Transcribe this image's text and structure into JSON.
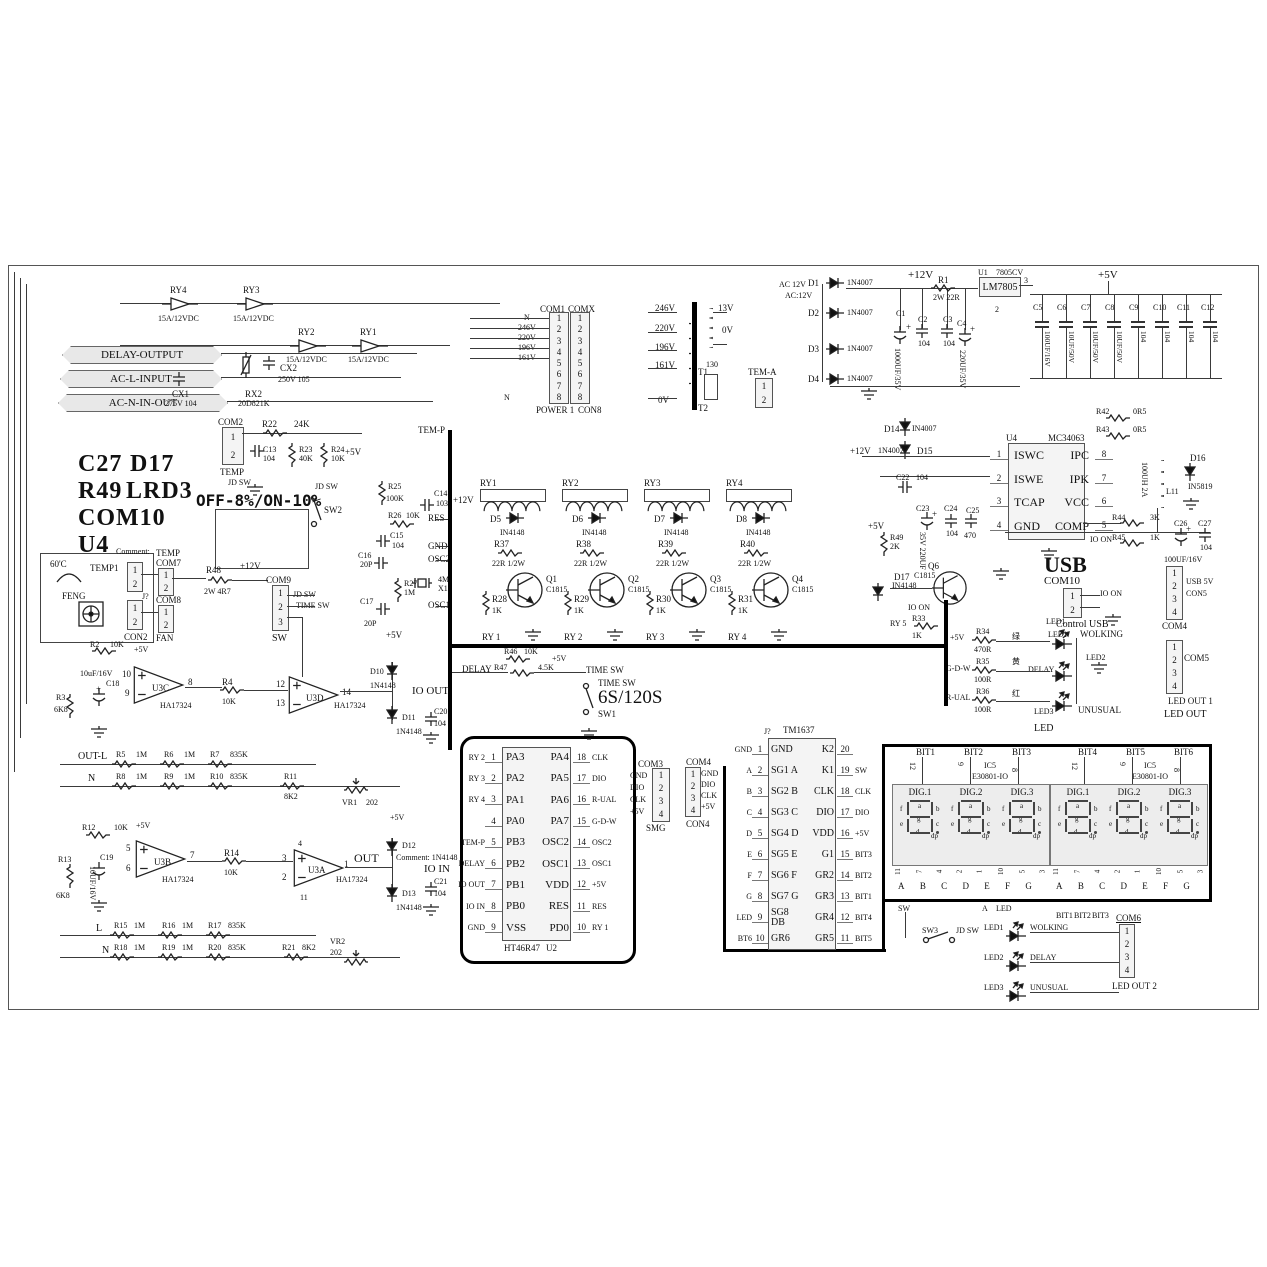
{
  "io_tags": {
    "delay_output": "DELAY-OUTPUT",
    "ac_l_input": "AC-L-INPUT",
    "ac_n_in_out": "AC-N-IN-OUT"
  },
  "top_relays": [
    {
      "ref": "RY4",
      "rating": "15A/12VDC"
    },
    {
      "ref": "RY3",
      "rating": "15A/12VDC"
    },
    {
      "ref": "RY2",
      "rating": "15A/12VDC"
    },
    {
      "ref": "RY1",
      "rating": "15A/12VDC"
    }
  ],
  "line_filter": {
    "cx1": "CX1",
    "cx1_val": "275V 104",
    "rx2": "RX2",
    "rx2_val": "20D821K",
    "cx2": "CX2",
    "cx2_val": "250V 105"
  },
  "com2": {
    "ref": "COM2",
    "pins": [
      "1",
      "2"
    ],
    "label": "TEMP",
    "jd": "JD SW"
  },
  "rc_top": {
    "r22": "R22",
    "r22_val": "24K",
    "c13": "C13",
    "c13_val": "104",
    "r23": "R23",
    "r23_val": "40K",
    "r24": "R24",
    "r24_val": "10K",
    "p5": "+5V",
    "jd": "JD SW",
    "jd2": "JD SW",
    "sw2": "SW2"
  },
  "tem_p": "TEM-P",
  "power_conn": {
    "com1": "COM1",
    "comx": "COMX",
    "nets": [
      "N",
      "246V",
      "220V",
      "196V",
      "161V"
    ],
    "pins": [
      "1",
      "2",
      "3",
      "4",
      "5",
      "6",
      "7",
      "8"
    ],
    "power": "POWER 1",
    "con8": "CON8",
    "n2": "N"
  },
  "transformer": {
    "taps": [
      "246V",
      "220V",
      "196V",
      "161V"
    ],
    "tap0": "0V",
    "sec_top": "13V",
    "sec_0": "0V",
    "t1": "T1",
    "t2": "T2",
    "fuse": "130",
    "tem_a": "TEM-A",
    "tem_pins": [
      "1",
      "2"
    ]
  },
  "rectifier": {
    "ac1": "AC 12V",
    "ac2": "AC:12V",
    "diodes": [
      {
        "ref": "D1",
        "val": "1N4007"
      },
      {
        "ref": "D2",
        "val": "1N4007"
      },
      {
        "ref": "D3",
        "val": "1N4007"
      },
      {
        "ref": "D4",
        "val": "1N4007"
      }
    ],
    "p12": "+12V",
    "r1": "R1",
    "r1_val": "2W 22R",
    "c1": "C1",
    "c1_val": "1000UF/35V",
    "c2": "C2",
    "c2_val": "104",
    "c3": "C3",
    "c3_val": "104",
    "c4": "C4",
    "c4_val": "220UF/35V",
    "u1": "U1",
    "u1_part": "7805CV",
    "reg": "LM7805",
    "pin2": "2",
    "pin3": "3"
  },
  "rail5": {
    "p5": "+5V",
    "caps": [
      {
        "ref": "C5",
        "val": "100UF/16V"
      },
      {
        "ref": "C6",
        "val": "10UF/50V"
      },
      {
        "ref": "C7",
        "val": "10UF/50V"
      },
      {
        "ref": "C8",
        "val": "10UF/50V"
      },
      {
        "ref": "C9",
        "val": "104"
      },
      {
        "ref": "C10",
        "val": "104"
      },
      {
        "ref": "C11",
        "val": "104"
      },
      {
        "ref": "C12",
        "val": "104"
      }
    ]
  },
  "dcdc": {
    "u4": "U4",
    "part": "MC34063",
    "rows": [
      {
        "ln": "1",
        "lname": "ISWC",
        "rname": "IPC",
        "rn": "8"
      },
      {
        "ln": "2",
        "lname": "ISWE",
        "rname": "IPK",
        "rn": "7"
      },
      {
        "ln": "3",
        "lname": "TCAP",
        "rname": "VCC",
        "rn": "6"
      },
      {
        "ln": "4",
        "lname": "GND",
        "rname": "COMP",
        "rn": "5"
      }
    ],
    "d14": "D14",
    "d14v": "IN4007",
    "d15": "D15",
    "d15v": "1N4007",
    "p12": "+12V",
    "c22": "C22",
    "c22v": "104",
    "r42": "R42",
    "r42v": "0R5",
    "r43": "R43",
    "r43v": "0R5",
    "p5": "+5V",
    "r49": "R49",
    "r49v": "2K",
    "c23": "C23",
    "c23v": "35V 220UF",
    "c24": "C24",
    "c24v": "104",
    "c25": "C25",
    "c25v": "470",
    "r44": "R44",
    "r44v": "3K",
    "io_on": "IO ON",
    "r45": "R45",
    "r45v": "1K",
    "l11": "L11",
    "l11v": "100UH 2A",
    "d16": "D16",
    "d16v": "IN5819",
    "c26": "C26",
    "c26v": "100UF/16V",
    "c27": "C27",
    "c27v": "104"
  },
  "usb": {
    "title": "USB",
    "com10": "COM10",
    "pins": [
      "1",
      "2"
    ],
    "io_on": "IO ON",
    "control": "Control USB",
    "led1": "LED1"
  },
  "q6blk": {
    "d17": "D17",
    "d17v": "IN4148",
    "q": "Q6",
    "qv": "C1815",
    "io_on": "IO ON",
    "ry5": "RY 5",
    "r33": "R33",
    "r33v": "1K"
  },
  "led_block": {
    "p5": "+5V",
    "r34": "R34",
    "r34v": "470R",
    "c_green": "绿",
    "led1": "LED1",
    "wolking": "WOLKING",
    "gdw": "G-D-W",
    "r35": "R35",
    "r35v": "100R",
    "c_yellow": "黄",
    "delay": "DELAY",
    "led2": "LED2",
    "rual": "R-UAL",
    "r36": "R36",
    "r36v": "100R",
    "c_red": "红",
    "led3": "LED3",
    "unusual": "UNUSUAL",
    "led": "LED"
  },
  "com4r": {
    "ref": "COM4",
    "pins": [
      "1",
      "2",
      "3",
      "4"
    ],
    "usb5": "USB 5V",
    "con5": "CON5"
  },
  "com5r": {
    "ref": "COM5",
    "pins": [
      "1",
      "2",
      "3",
      "4"
    ],
    "out1": "LED OUT 1",
    "out": "LED OUT"
  },
  "big_text": {
    "l1a": "C27",
    "l1b": "D17",
    "l2a": "R49",
    "l2b": "LRD3",
    "l3": "COM10",
    "l4": "U4",
    "l5": "Q6"
  },
  "mode_label": "OFF-8%/ON-10%",
  "sensor": {
    "deg": "60'C",
    "temp1": "TEMP1",
    "pins_a": [
      "1",
      "2"
    ],
    "feng": "FENG",
    "jq": "J?",
    "pins_b": [
      "1",
      "2"
    ],
    "con2": "CON2",
    "comment": "Comment:",
    "temp": "TEMP",
    "com7": "COM7",
    "pins_c": [
      "1",
      "2"
    ],
    "com8": "COM8",
    "pins_d": [
      "1",
      "2"
    ],
    "fan": "FAN"
  },
  "r48": {
    "ref": "R48",
    "val": "2W 4R7",
    "p12": "+12V"
  },
  "com9": {
    "ref": "COM9",
    "pins": [
      "1",
      "2",
      "3"
    ],
    "label": "SW",
    "jd": "JD SW",
    "time": "TIME SW"
  },
  "osc": {
    "r25": "R25",
    "r25v": "100K",
    "r26": "R26",
    "r26v": "10K",
    "res": "RES",
    "c14": "C14",
    "c14v": "103",
    "c15": "C15",
    "c15v": "104",
    "gnd": "GND",
    "c16": "C16",
    "c16v": "20P",
    "osc2": "OSC2",
    "r27": "R27",
    "r27v": "1M",
    "x1": "X1",
    "x1v": "4M",
    "c17": "C17",
    "c17v": "20P",
    "osc1": "OSC1",
    "p5": "+5V"
  },
  "drivers": {
    "p12": "+12V",
    "cells": [
      {
        "ry": "RY1",
        "d": "D5",
        "dv": "IN4148",
        "r": "R37",
        "rv": "22R 1/2W",
        "q": "Q1",
        "qv": "C1815",
        "rb": "R28",
        "rbv": "1K",
        "net": "RY 1"
      },
      {
        "ry": "RY2",
        "d": "D6",
        "dv": "IN4148",
        "r": "R38",
        "rv": "22R 1/2W",
        "q": "Q2",
        "qv": "C1815",
        "rb": "R29",
        "rbv": "1K",
        "net": "RY 2"
      },
      {
        "ry": "RY3",
        "d": "D7",
        "dv": "IN4148",
        "r": "R39",
        "rv": "22R 1/2W",
        "q": "Q3",
        "qv": "C1815",
        "rb": "R30",
        "rbv": "1K",
        "net": "RY 3"
      },
      {
        "ry": "RY4",
        "d": "D8",
        "dv": "IN4148",
        "r": "R40",
        "rv": "22R 1/2W",
        "q": "Q4",
        "qv": "C1815",
        "rb": "R31",
        "rbv": "1K",
        "net": "RY 4"
      }
    ]
  },
  "timing": {
    "delay": "DELAY",
    "r46": "R46",
    "r46v": "10K",
    "p5": "+5V",
    "r47": "R47",
    "r47v": "4.5K",
    "tsw1": "TIME SW",
    "tsw2": "TIME SW",
    "rate": "6S/120S",
    "sw1": "SW1"
  },
  "mcu": {
    "part": "HT46R47",
    "ref": "U2",
    "rows": [
      {
        "lnet": "RY 2",
        "lnum": "1",
        "lname": "PA3",
        "rname": "PA4",
        "rnum": "18",
        "rnet": "CLK"
      },
      {
        "lnet": "RY 3",
        "lnum": "2",
        "lname": "PA2",
        "rname": "PA5",
        "rnum": "17",
        "rnet": "DIO"
      },
      {
        "lnet": "RY 4",
        "lnum": "3",
        "lname": "PA1",
        "rname": "PA6",
        "rnum": "16",
        "rnet": "R-UAL"
      },
      {
        "lnet": "",
        "lnum": "4",
        "lname": "PA0",
        "rname": "PA7",
        "rnum": "15",
        "rnet": "G-D-W"
      },
      {
        "lnet": "TEM-P",
        "lnum": "5",
        "lname": "PB3",
        "rname": "OSC2",
        "rnum": "14",
        "rnet": "OSC2"
      },
      {
        "lnet": "DELAY",
        "lnum": "6",
        "lname": "PB2",
        "rname": "OSC1",
        "rnum": "13",
        "rnet": "OSC1"
      },
      {
        "lnet": "IO OUT",
        "lnum": "7",
        "lname": "PB1",
        "rname": "VDD",
        "rnum": "12",
        "rnet": "+5V"
      },
      {
        "lnet": "IO IN",
        "lnum": "8",
        "lname": "PB0",
        "rname": "RES",
        "rnum": "11",
        "rnet": "RES"
      },
      {
        "lnet": "GND",
        "lnum": "9",
        "lname": "VSS",
        "rname": "PD0",
        "rnum": "10",
        "rnet": "RY 1"
      }
    ]
  },
  "com3": {
    "ref": "COM3",
    "nets": [
      "GND",
      "DIO",
      "CLK",
      "+5V"
    ],
    "pins": [
      "1",
      "2",
      "3",
      "4"
    ],
    "label": "SMG"
  },
  "amp1": {
    "r2": "R2",
    "r2v": "10K",
    "p5": "+5V",
    "c18": "C18",
    "c18v": "10uF/16V",
    "r3": "R3",
    "r3v": "6K8",
    "u": "U3C",
    "upart": "HA17324",
    "pi1": "10",
    "pi2": "9",
    "po": "8",
    "r4": "R4",
    "r4v": "10K",
    "u2": "U3D",
    "u2part": "HA17324",
    "p2i1": "12",
    "p2i2": "13",
    "p2o": "14",
    "d10": "D10",
    "d10v": "1N4148",
    "io_out": "IO OUT",
    "d11": "D11",
    "d11v": "1N4148",
    "c20": "C20",
    "c20v": "104",
    "out_l": "OUT-L",
    "lad1": [
      {
        "ref": "R5",
        "val": "1M"
      },
      {
        "ref": "R6",
        "val": "1M"
      },
      {
        "ref": "R7",
        "val": "835K"
      }
    ],
    "n": "N",
    "lad2": [
      {
        "ref": "R8",
        "val": "1M"
      },
      {
        "ref": "R9",
        "val": "1M"
      },
      {
        "ref": "R10",
        "val": "835K"
      }
    ],
    "r11": "R11",
    "r11v": "8K2",
    "vr1": "VR1",
    "vr1v": "202"
  },
  "amp2": {
    "r12": "R12",
    "r12v": "10K",
    "p5": "+5V",
    "c19": "C19",
    "c19v": "10UF/16V",
    "r13": "R13",
    "r13v": "6K8",
    "u": "U3B",
    "upart": "HA17324",
    "pi1": "5",
    "pi2": "6",
    "po": "7",
    "r14": "R14",
    "r14v": "10K",
    "u2": "U3A",
    "u2part": "HA17324",
    "p2i1": "3",
    "p2i2": "2",
    "p2o": "1",
    "pv1": "4",
    "pv2": "11",
    "out": "OUT",
    "p5b": "+5V",
    "d12": "D12",
    "d12v": "Comment: 1N4148",
    "io_in": "IO IN",
    "d13": "D13",
    "d13v": "1N4148",
    "c21": "C21",
    "c21v": "104",
    "l": "L",
    "lad1": [
      {
        "ref": "R15",
        "val": "1M"
      },
      {
        "ref": "R16",
        "val": "1M"
      },
      {
        "ref": "R17",
        "val": "835K"
      }
    ],
    "n": "N",
    "lad2": [
      {
        "ref": "R18",
        "val": "1M"
      },
      {
        "ref": "R19",
        "val": "1M"
      },
      {
        "ref": "R20",
        "val": "835K"
      }
    ],
    "r21": "R21",
    "r21v": "8K2",
    "vr2": "VR2",
    "vr2v": "202"
  },
  "tm1637": {
    "part": "TM1637",
    "ref": "J?",
    "rows": [
      {
        "lnet": "GND",
        "lnum": "1",
        "lname": "GND",
        "rname": "K2",
        "rnum": "20",
        "rnet": ""
      },
      {
        "lnet": "A",
        "lnum": "2",
        "lname": "SG1 A",
        "rname": "K1",
        "rnum": "19",
        "rnet": "SW"
      },
      {
        "lnet": "B",
        "lnum": "3",
        "lname": "SG2 B",
        "rname": "CLK",
        "rnum": "18",
        "rnet": "CLK"
      },
      {
        "lnet": "C",
        "lnum": "4",
        "lname": "SG3 C",
        "rname": "DIO",
        "rnum": "17",
        "rnet": "DIO"
      },
      {
        "lnet": "D",
        "lnum": "5",
        "lname": "SG4 D",
        "rname": "VDD",
        "rnum": "16",
        "rnet": "+5V"
      },
      {
        "lnet": "E",
        "lnum": "6",
        "lname": "SG5 E",
        "rname": "G1",
        "rnum": "15",
        "rnet": "BIT3"
      },
      {
        "lnet": "F",
        "lnum": "7",
        "lname": "SG6 F",
        "rname": "GR2",
        "rnum": "14",
        "rnet": "BIT2"
      },
      {
        "lnet": "G",
        "lnum": "8",
        "lname": "SG7 G",
        "rname": "GR3",
        "rnum": "13",
        "rnet": "BIT1"
      },
      {
        "lnet": "LED",
        "lnum": "9",
        "lname": "SG8 DB",
        "rname": "GR4",
        "rnum": "12",
        "rnet": "BIT4"
      },
      {
        "lnet": "BT6",
        "lnum": "10",
        "lname": "GR6",
        "rname": "GR5",
        "rnum": "11",
        "rnet": "BIT5"
      }
    ]
  },
  "com4l": {
    "ref": "COM4",
    "nets": [
      "GND",
      "DIO",
      "CLK",
      "+5V"
    ],
    "pins": [
      "1",
      "2",
      "3",
      "4"
    ],
    "label": "CON4"
  },
  "displays": {
    "bits": [
      "BIT1",
      "BIT2",
      "BIT3",
      "BIT4",
      "BIT5",
      "BIT6"
    ],
    "bit_pins": [
      "12",
      "9",
      "8",
      "12",
      "9",
      "8"
    ],
    "ic": "IC5",
    "part": "E30801-IO",
    "m1_digits": [
      "DIG.1",
      "DIG.2",
      "DIG.3"
    ],
    "m2_digits": [
      "DIG.1",
      "DIG.2",
      "DIG.3"
    ],
    "segs": {
      "a": "a",
      "b": "b",
      "c": "c",
      "d": "d",
      "e": "e",
      "f": "f",
      "g": "g",
      "dp": "dp"
    },
    "bottom_pins": [
      "11",
      "7",
      "4",
      "2",
      "1",
      "10",
      "5",
      "3"
    ],
    "bottom_letters": [
      "A",
      "B",
      "C",
      "D",
      "E",
      "F",
      "G"
    ]
  },
  "bottom": {
    "sw": "SW",
    "sw3": "SW3",
    "jd": "JD SW",
    "a": "A",
    "led": "LED",
    "led1": "LED1",
    "wolking": "WOLKING",
    "led2": "LED2",
    "delay": "DELAY",
    "led3": "LED3",
    "unusual": "UNUSUAL",
    "bit1": "BIT1",
    "bit2": "BIT2",
    "bit3": "BIT3",
    "com6": "COM6",
    "pins": [
      "1",
      "2",
      "3",
      "4"
    ],
    "out2": "LED OUT 2"
  }
}
